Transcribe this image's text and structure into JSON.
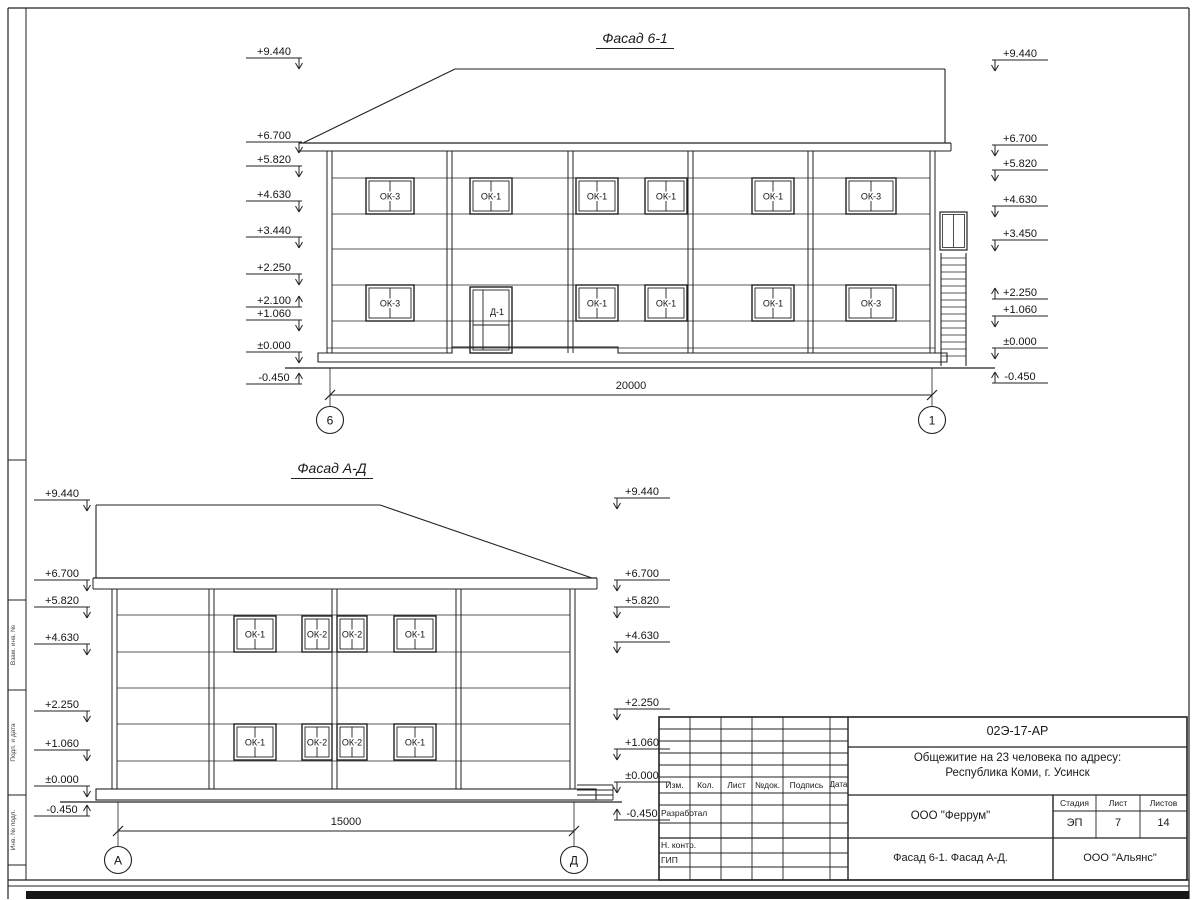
{
  "sheet": {
    "facades": [
      {
        "title": "Фасад 6-1",
        "elevations_left": [
          "+9.440",
          "+6.700",
          "+5.820",
          "+4.630",
          "+3.440",
          "+2.250",
          "+2.100",
          "+1.060",
          "±0.000",
          "-0.450"
        ],
        "elevations_right": [
          "+9.440",
          "+6.700",
          "+5.820",
          "+4.630",
          "+3.450",
          "+2.250",
          "+1.060",
          "±0.000",
          "-0.450"
        ],
        "windows_upper": [
          "ОК-3",
          "ОК-1",
          "ОК-1",
          "ОК-1",
          "ОК-1",
          "ОК-3"
        ],
        "windows_lower": [
          "ОК-3",
          "ОК-1",
          "ОК-1",
          "ОК-1",
          "ОК-3"
        ],
        "door_label": "Д-1",
        "dimension": "20000",
        "axis_left": "6",
        "axis_right": "1"
      },
      {
        "title": "Фасад А-Д",
        "elevations_left": [
          "+9.440",
          "+6.700",
          "+5.820",
          "+4.630",
          "+2.250",
          "+1.060",
          "±0.000",
          "-0.450"
        ],
        "elevations_right": [
          "+9.440",
          "+6.700",
          "+5.820",
          "+4.630",
          "+2.250",
          "+1.060",
          "±0.000",
          "-0.450"
        ],
        "windows_upper": [
          "ОК-1",
          "ОК-2",
          "ОК-2",
          "ОК-1"
        ],
        "windows_lower": [
          "ОК-1",
          "ОК-2",
          "ОК-2",
          "ОК-1"
        ],
        "dimension": "15000",
        "axis_left": "А",
        "axis_right": "Д"
      }
    ],
    "side_stamp": [
      "Взам. инв. №",
      "Подп. и дата",
      "Инв. № подл."
    ],
    "title_block": {
      "doc_code": "02Э-17-АР",
      "project_name_line1": "Общежитие на 23 человека по адресу:",
      "project_name_line2": "Республика Коми, г. Усинск",
      "header_columns": [
        "Изм.",
        "Кол.",
        "Лист",
        "№док.",
        "Подпись",
        "Дата"
      ],
      "role_rows": [
        "Разработал",
        "Н. контр.",
        "ГИП"
      ],
      "contractor": "ООО \"Феррум\"",
      "stage_label": "Стадия",
      "sheet_label": "Лист",
      "sheets_label": "Листов",
      "stage_value": "ЭП",
      "sheet_value": "7",
      "sheets_value": "14",
      "drawing_title": "Фасад 6-1. Фасад  А-Д.",
      "design_org": "ООО \"Альянс\""
    },
    "colors": {
      "line": "#222222",
      "background": "#ffffff"
    }
  }
}
